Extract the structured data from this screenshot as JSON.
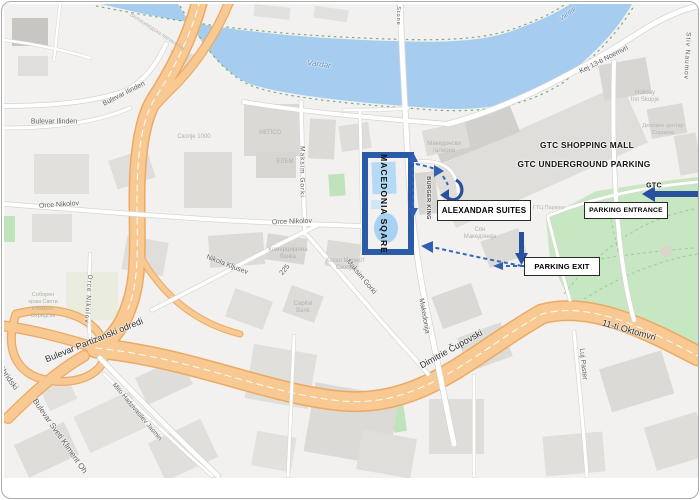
{
  "annotations": {
    "square": "MACEDONIA SQARE",
    "suites": "ALEXANDAR SUITES",
    "mall": "GTC SHOPPING MALL",
    "underground": "GTC UNDERGROUND PARKING",
    "gtc": "GTC",
    "entrance": "PARKING ENTRANCE",
    "exit": "PARKING EXIT"
  },
  "streets": {
    "vardar": "Vardar",
    "bike_path": "Велосипедска патека Кеј",
    "ilinden": "Bulevar Ilinden",
    "kej": "Kej 13-ti Noemvri",
    "stiv": "Stiv Naumov",
    "orce": "Orce Nikolov",
    "nikola": "Nikola Kljusev",
    "n225": "225",
    "maksim": "Maksim Gorki",
    "makedonija": "Makedonija",
    "dimitrie": "Dimitrie Čupovski",
    "oktomvri": "11-ti Oktomvri",
    "luj": "Luj Paster",
    "mito": "Mito Hadzivasilev Jasmin",
    "partizanski": "Bulevar Partizanski odredi",
    "sveti": "Bulevar Sveti Kliment Oh",
    "ohridski": "Ohridski",
    "stone": "Stone",
    "burger": "BURGER KING"
  },
  "pois": {
    "skopje": "Скопје 1000",
    "mepso": "МЕПСО",
    "elem": "ЕЛЕМ",
    "galerii1": "Македонски",
    "galerii2": "галерии",
    "holiday1": "Holiday",
    "holiday2": "Inn Skopje",
    "delov1": "Деловен центар",
    "delov2": "Соравиа",
    "gtcpark": "ГТЦ Паркинг",
    "son1": "Сон",
    "son2": "Македонија",
    "kb1": "Комерцијална",
    "kb2": "банка",
    "hotel1": "Хотел Мариот",
    "hotel2": "Скопје",
    "cap1": "Capital",
    "cap2": "Bank",
    "sob1": "Соборен",
    "sob2": "храм Свети",
    "sob3": "Климент",
    "sob4": "Охридски"
  },
  "colors": {
    "accent_blue": "#2b5aa7",
    "water": "#a6cdf0",
    "park": "#c7e7c3",
    "road_orange": "#f8c992"
  }
}
